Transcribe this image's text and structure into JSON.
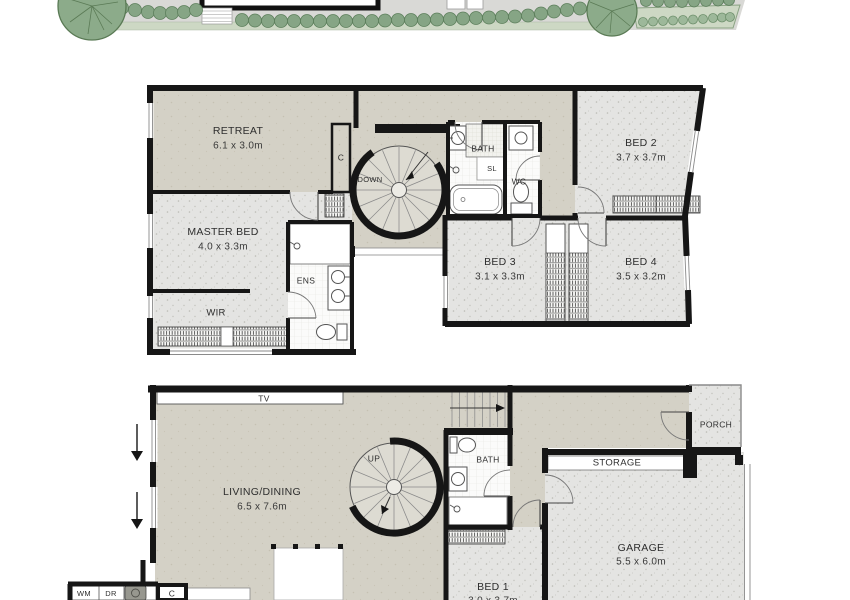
{
  "document": {
    "type": "floorplan-drawing"
  },
  "colors": {
    "wall": "#161616",
    "carpet_hall": "#d4d1c6",
    "room_floor": "#e4e4e2",
    "tile": "#fbfbfa",
    "site_ground": "#d9d9d6",
    "garden_bed": "#cdd8c4",
    "tree": "#8cab8a",
    "label_text": "#2e2e2e"
  },
  "upper_floor": {
    "retreat": {
      "name": "RETREAT",
      "dims": "6.1 x 3.0m"
    },
    "cupboard": {
      "name": "C"
    },
    "stair": {
      "name": "DOWN"
    },
    "bath": {
      "name": "BATH"
    },
    "skylight": {
      "name": "SL"
    },
    "wc": {
      "name": "WC"
    },
    "bed2": {
      "name": "BED 2",
      "dims": "3.7 x 3.7m"
    },
    "master_bed": {
      "name": "MASTER BED",
      "dims": "4.0 x 3.3m"
    },
    "ens": {
      "name": "ENS"
    },
    "wir": {
      "name": "WIR"
    },
    "bed3": {
      "name": "BED 3",
      "dims": "3.1 x 3.3m"
    },
    "bed4": {
      "name": "BED 4",
      "dims": "3.5 x 3.2m"
    }
  },
  "ground_floor": {
    "tv": {
      "name": "TV"
    },
    "living_dining": {
      "name": "LIVING/DINING",
      "dims": "6.5 x 7.6m"
    },
    "stair": {
      "name": "UP"
    },
    "bath": {
      "name": "BATH"
    },
    "storage": {
      "name": "STORAGE"
    },
    "porch": {
      "name": "PORCH"
    },
    "garage": {
      "name": "GARAGE",
      "dims": "5.5 x 6.0m"
    },
    "bed1": {
      "name": "BED 1",
      "dims": "3.0 x 3.7m"
    },
    "laundry": {
      "wm": "WM",
      "dr": "DR",
      "cupboard": "C"
    }
  }
}
